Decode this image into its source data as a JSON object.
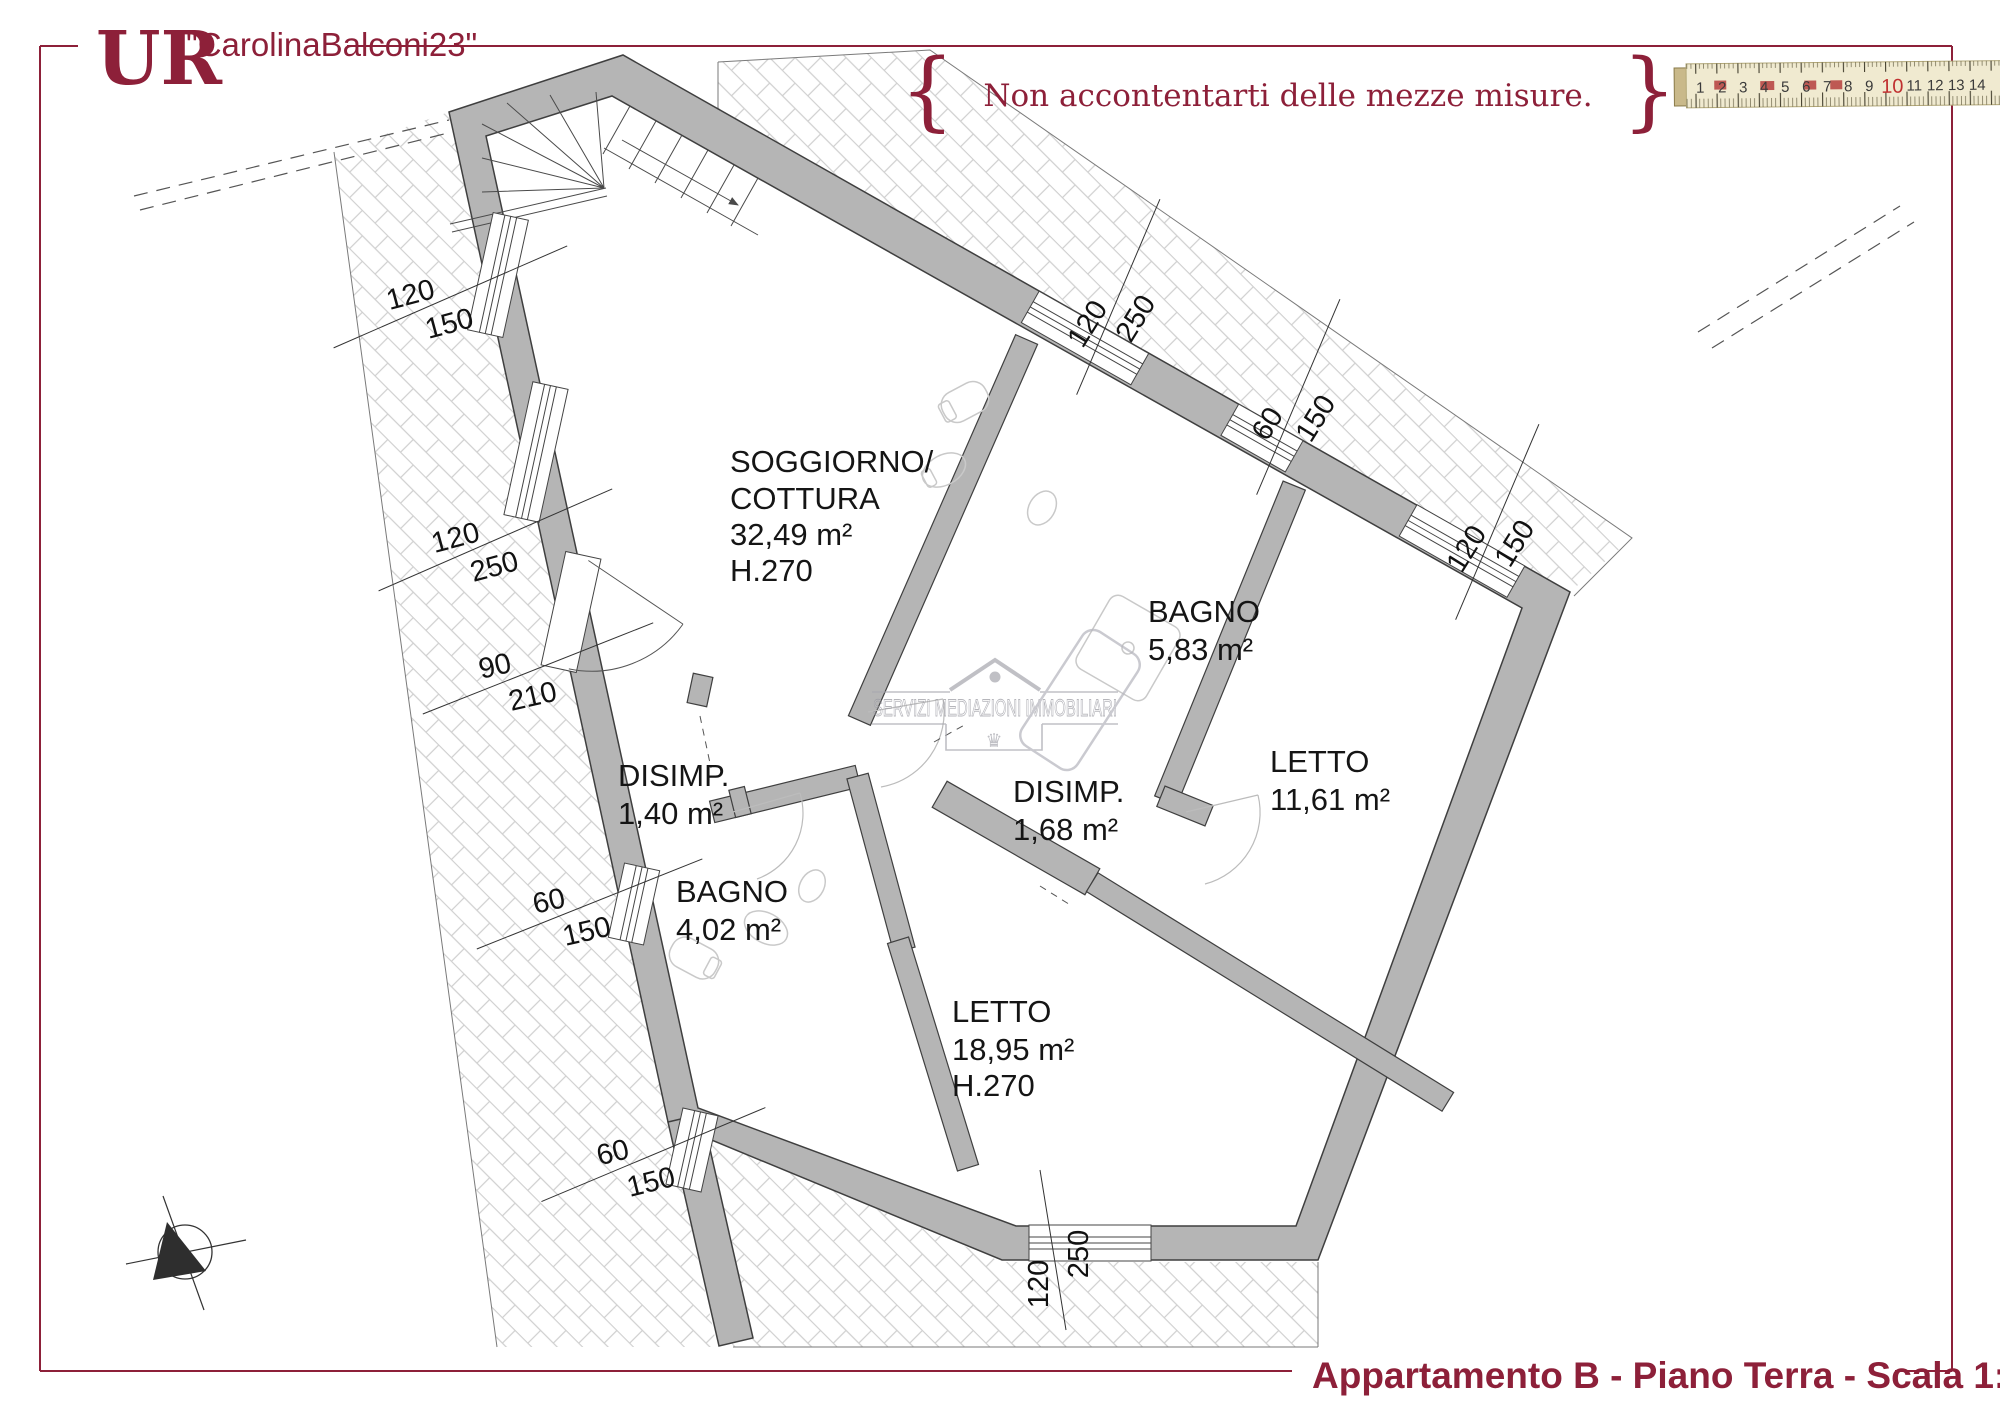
{
  "header": {
    "logo": "UR",
    "listing_code": "\"CarolinaBalconi23\"",
    "brace_left": "{",
    "brace_right": "}",
    "tagline": "Non accontentarti delle mezze misure."
  },
  "ruler": {
    "numbers": [
      "1",
      "2",
      "3",
      "4",
      "5",
      "6",
      "7",
      "8",
      "9",
      "10",
      "11",
      "12",
      "13",
      "14"
    ]
  },
  "rooms": {
    "soggiorno": {
      "line1": "SOGGIORNO/",
      "line2": "COTTURA",
      "area": "32,49 m²",
      "height": "H.270"
    },
    "bagno1": {
      "name": "BAGNO",
      "area": "5,83 m²"
    },
    "letto1": {
      "name": "LETTO",
      "area": "11,61 m²"
    },
    "disimp1": {
      "name": "DISIMP.",
      "area": "1,40 m²"
    },
    "disimp2": {
      "name": "DISIMP.",
      "area": "1,68 m²"
    },
    "bagno2": {
      "name": "BAGNO",
      "area": "4,02 m²"
    },
    "letto2": {
      "name": "LETTO",
      "area": "18,95 m²",
      "height": "H.270"
    }
  },
  "dims": {
    "left_top": {
      "num": "120",
      "den": "150"
    },
    "left_mid": {
      "num": "120",
      "den": "250"
    },
    "entrance": {
      "num": "90",
      "den": "210"
    },
    "left_low": {
      "num": "60",
      "den": "150"
    },
    "bottom_left": {
      "num": "60",
      "den": "150"
    },
    "bottom": {
      "num": "120",
      "den": "250"
    },
    "top_mid": {
      "num": "120",
      "den": "250"
    },
    "right_up": {
      "num": "60",
      "den": "150"
    },
    "right_low": {
      "num": "120",
      "den": "150"
    }
  },
  "watermark": {
    "text": "SERVIZI MEDIAZIONI IMMOBILIARI",
    "crown": "♛"
  },
  "footer": {
    "title": "Appartamento B - Piano Terra - Scala 1:50"
  },
  "colors": {
    "accent": "#8d2039",
    "wall": "#b5b5b5",
    "hatch": "#cfcfcf"
  }
}
